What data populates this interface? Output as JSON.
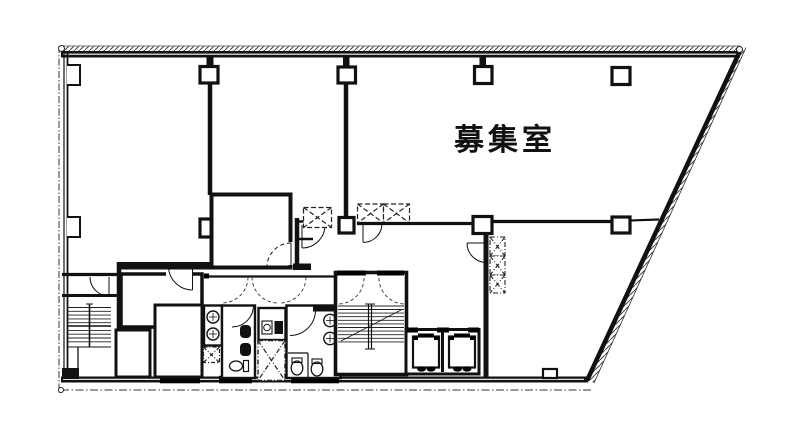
{
  "title": "building-floor-plan",
  "labels": {
    "room": "募集室"
  },
  "colors": {
    "ink": "#111111",
    "background": "#ffffff"
  }
}
